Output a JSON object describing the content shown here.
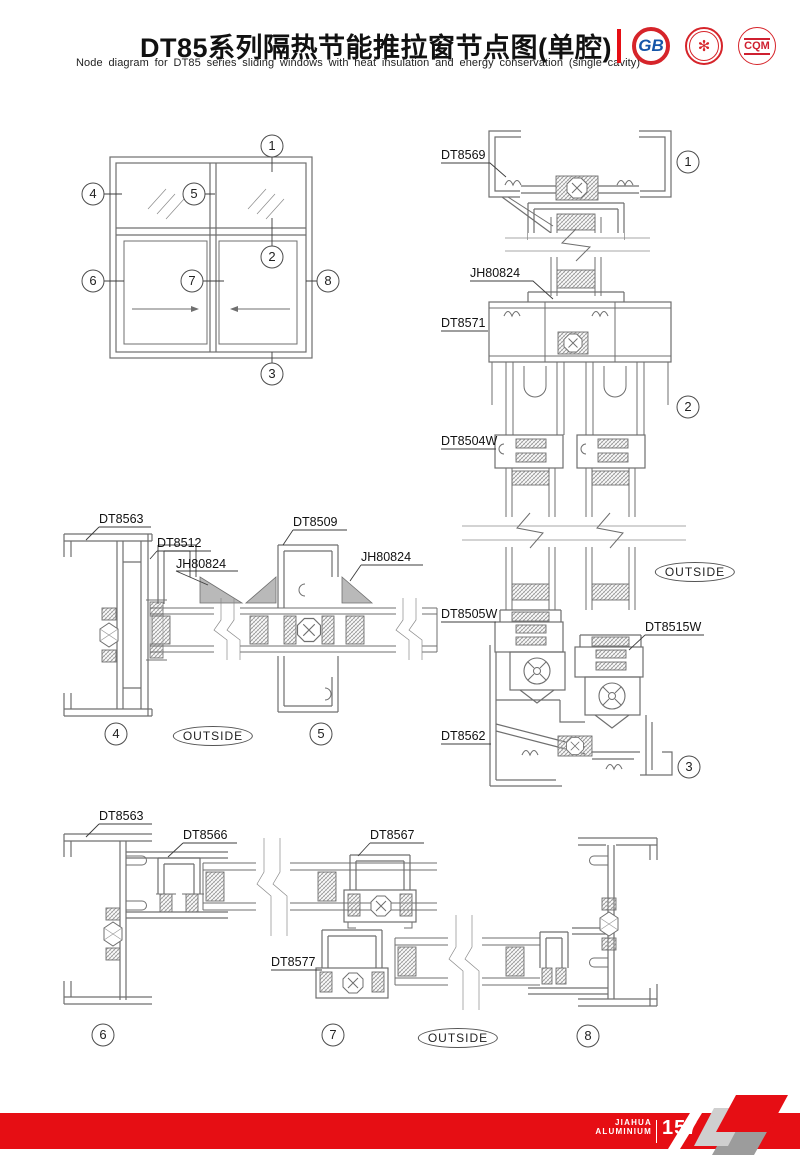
{
  "header": {
    "title_cn": "DT85系列隔热节能推拉窗节点图(单腔)",
    "title_en": "Node diagram for DT85 series sliding windows with heat insulation and energy conservation (single cavity)",
    "logos": {
      "gb_text": "GB",
      "seal_glyph": "✻",
      "cqm_text": "CQM"
    }
  },
  "callouts": {
    "c1": "1",
    "c2": "2",
    "c3": "3",
    "c4": "4",
    "c5": "5",
    "c6": "6",
    "c7": "7",
    "c8": "8"
  },
  "labels": {
    "outside": "OUTSIDE",
    "dt8569": "DT8569",
    "jh80824": "JH80824",
    "dt8571": "DT8571",
    "dt8504w": "DT8504W",
    "dt8505w": "DT8505W",
    "dt8515w": "DT8515W",
    "dt8562": "DT8562",
    "dt8563": "DT8563",
    "dt8512": "DT8512",
    "dt8509": "DT8509",
    "dt8566": "DT8566",
    "dt8567": "DT8567",
    "dt8577": "DT8577"
  },
  "footer": {
    "brand_line1": "JIAHUA",
    "brand_line2": "ALUMINIUM",
    "page_number": "157"
  }
}
